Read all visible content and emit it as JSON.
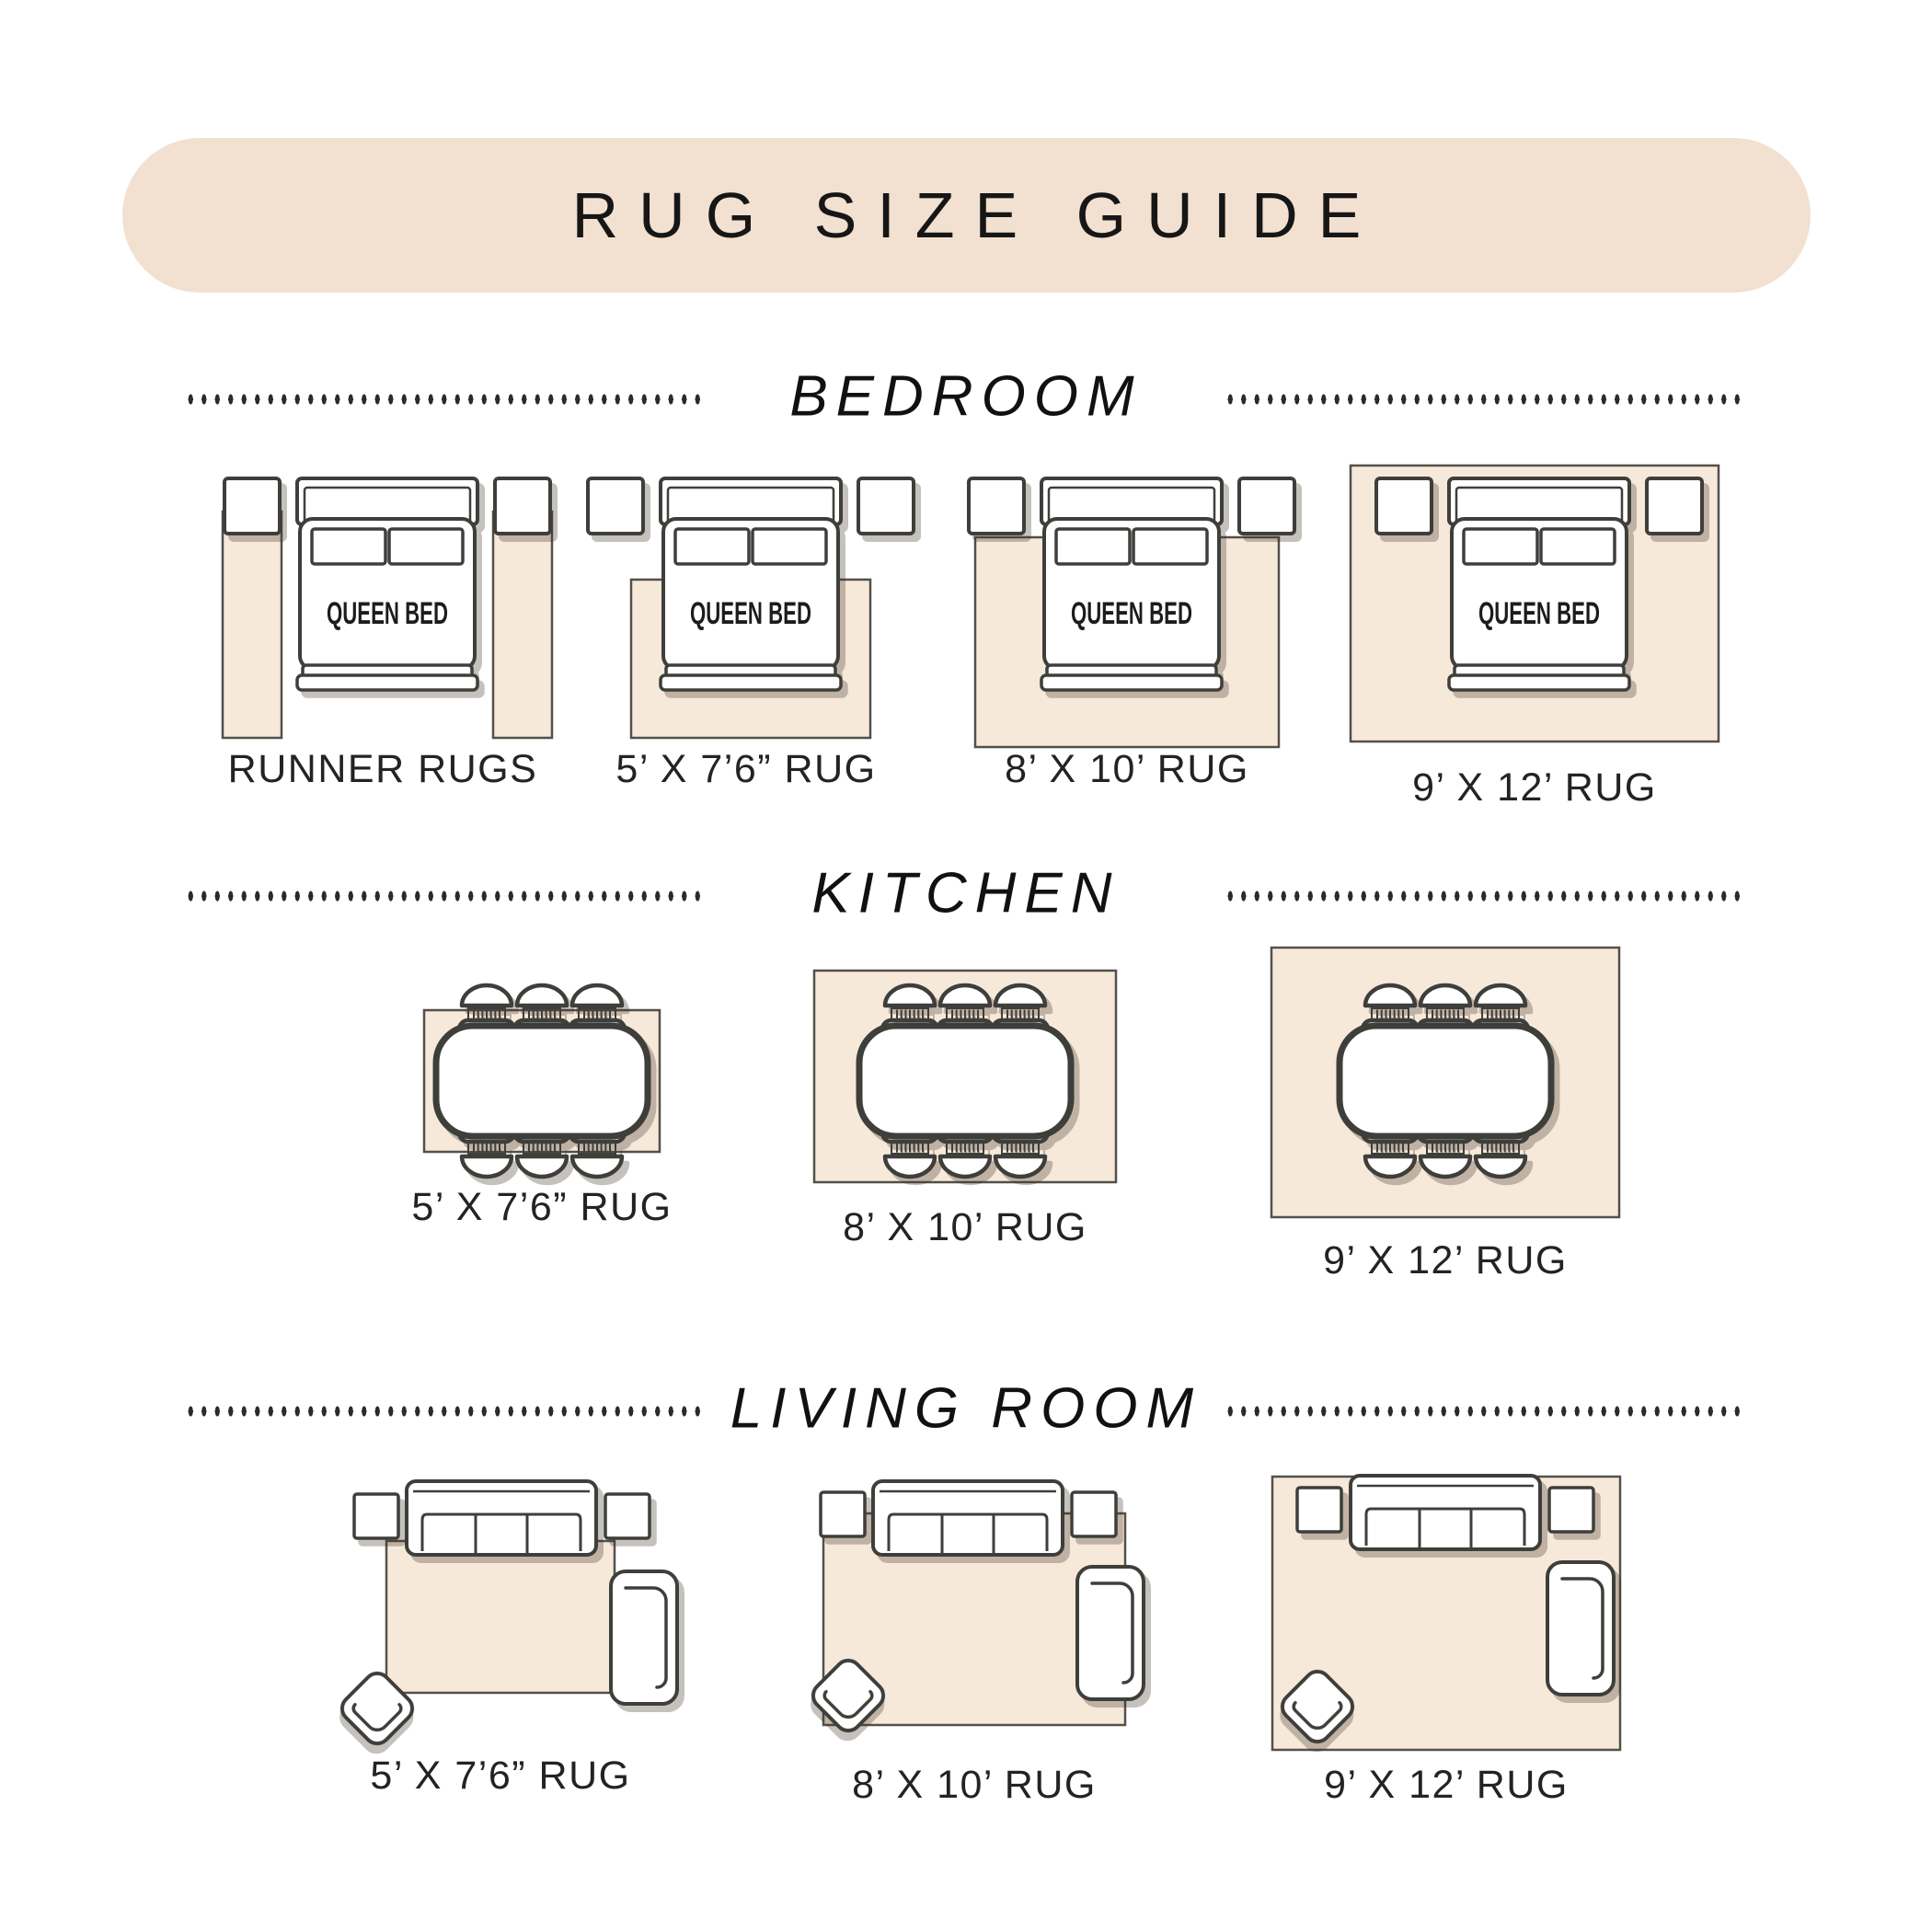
{
  "title": "RUG SIZE GUIDE",
  "labels": {
    "queen_bed": "QUEEN BED"
  },
  "sections": [
    {
      "label": "BEDROOM",
      "items": [
        {
          "label": "RUNNER RUGS"
        },
        {
          "label": "5’ X 7’6” RUG"
        },
        {
          "label": "8’ X 10’ RUG"
        },
        {
          "label": "9’ X 12’ RUG"
        }
      ]
    },
    {
      "label": "KITCHEN",
      "items": [
        {
          "label": "5’ X 7’6” RUG"
        },
        {
          "label": "8’ X 10’ RUG"
        },
        {
          "label": "9’ X 12’ RUG"
        }
      ]
    },
    {
      "label": "LIVING ROOM",
      "items": [
        {
          "label": "5’ X 7’6” RUG"
        },
        {
          "label": "8’ X 10’ RUG"
        },
        {
          "label": "9’ X 12’ RUG"
        }
      ]
    }
  ],
  "colors": {
    "header_pill_bg": "#f2e0d0",
    "rug_fill": "#f7e9da",
    "outline": "#3e3e3b",
    "label_text": "#232323",
    "shadow": "rgba(62,49,36,0.30)"
  }
}
